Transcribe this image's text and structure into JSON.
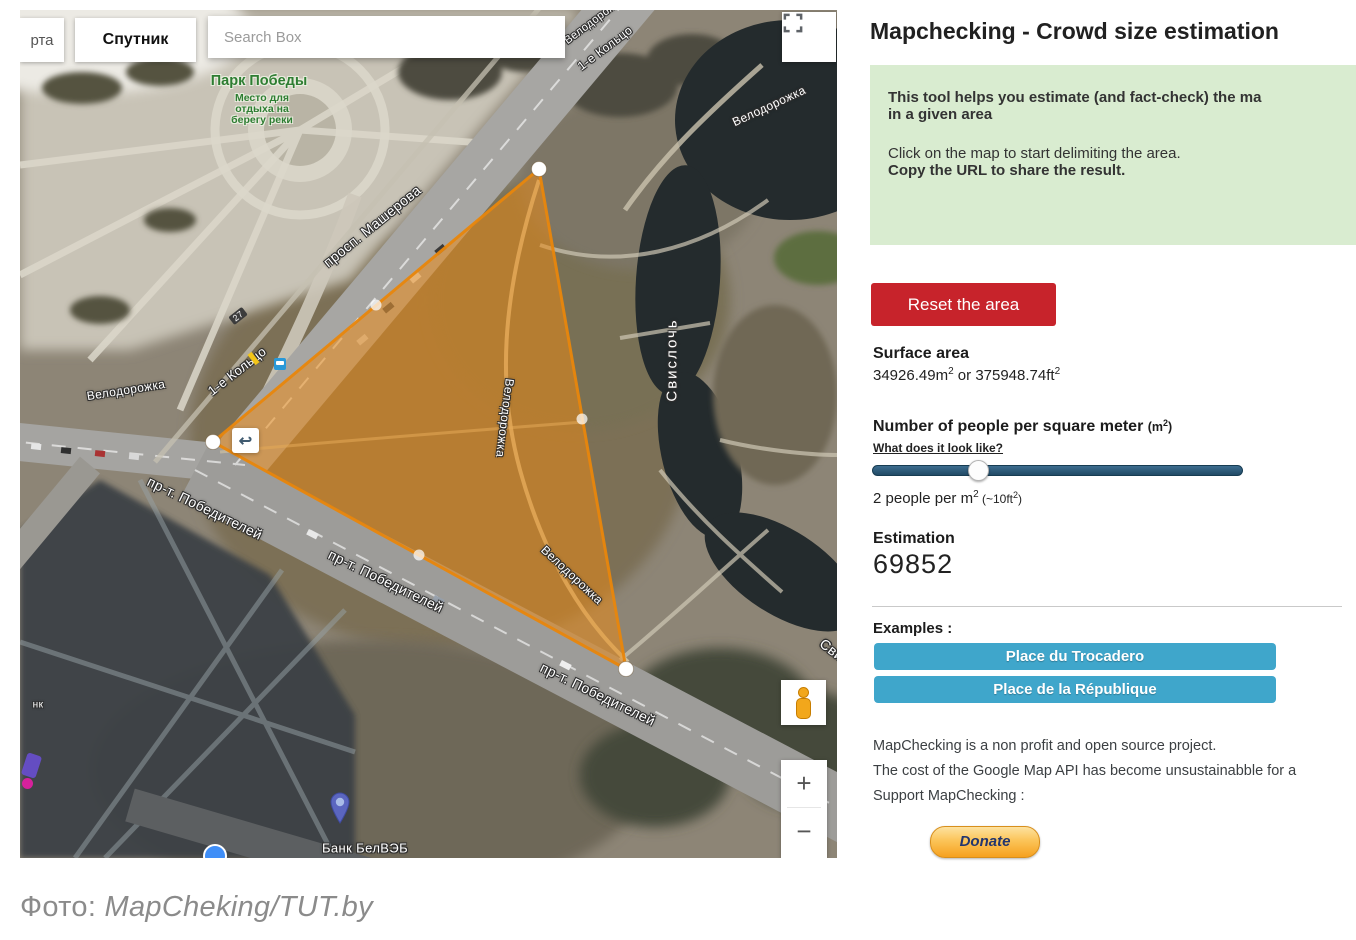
{
  "map": {
    "tabs": {
      "map_tab_partial": "рта",
      "satellite_tab": "Спутник"
    },
    "search": {
      "placeholder": "Search Box"
    },
    "labels": {
      "park": "Парк Победы",
      "park_sub1": "Место для",
      "park_sub2": "отдыха на",
      "park_sub3": "берегу реки",
      "masherova": "просп. Машерова",
      "koltso": "1-е Кольцо",
      "velodorozhka": "Велодорожка",
      "pobediteley": "пр-т. Победителей",
      "svisloch": "Свислочь",
      "svisloch_partial": "Свис",
      "bank": "Банк БелВЭБ",
      "route27": "27",
      "nk": "нк"
    },
    "controls": {
      "undo_arrow": "↩",
      "zoom_in": "+",
      "zoom_out": "−"
    }
  },
  "panel": {
    "title": "Mapchecking - Crowd size estimation",
    "info_box": {
      "bold_line1": "This tool helps you estimate (and fact-check) the ma",
      "bold_line2": "in a given area",
      "line3": "Click on the map to start delimiting the area.",
      "bold_line4": "Copy the URL to share the result."
    },
    "reset_button": "Reset the area",
    "surface": {
      "heading": "Surface area",
      "m2": "34926.49m",
      "sup1": "2",
      "mid": " or ",
      "ft2": "375948.74ft",
      "sup2": "2"
    },
    "density": {
      "heading": "Number of people per square meter ",
      "unit_prefix": "(m",
      "unit_sup": "2",
      "unit_suffix": ")",
      "link": "What does it look like?",
      "value_prefix": "2 people per m",
      "value_sup1": "2",
      "note_prefix": " (~10ft",
      "value_sup2": "2",
      "note_suffix": ")"
    },
    "estimation": {
      "heading": "Estimation",
      "value": "69852"
    },
    "examples": {
      "heading": "Examples :",
      "button1": "Place du Trocadero",
      "button2": "Place de la République"
    },
    "footer": {
      "line1": "MapChecking is a non profit and open source project.",
      "line2": "The cost of the Google Map API has become unsustainabble for a",
      "line3": "Support MapChecking :",
      "donate": "Donate"
    }
  },
  "caption": {
    "prefix": "Фото: ",
    "credit": "MapCheking/TUT.by"
  },
  "colors": {
    "polygon": "#ed8b11",
    "reset_red": "#c7232b",
    "example_blue": "#3fa6cb",
    "info_green": "#d9ecd0",
    "slider_track": "#2b5d7e"
  }
}
